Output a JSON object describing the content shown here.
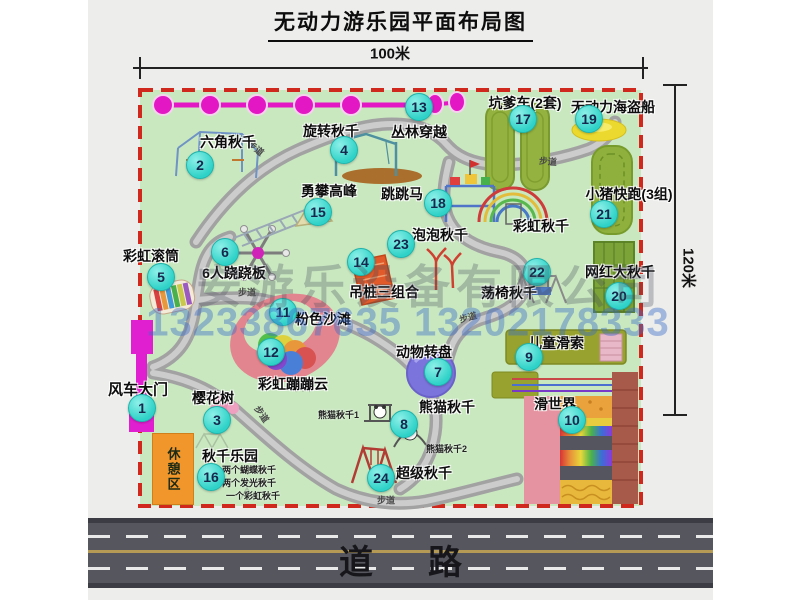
{
  "title": "无动力游乐园平面布局图",
  "dim_top": "100米",
  "dim_right": "120米",
  "road_label": "道路",
  "walkway": "步道",
  "rest_area": "休憩区",
  "watermark": {
    "company": "安游乐设备有限公司",
    "phone": "13233867635 13202178333"
  },
  "attractions": {
    "a1": {
      "num": "1",
      "label": "风车大门"
    },
    "a2": {
      "num": "2",
      "label": "六角秋千"
    },
    "a3": {
      "num": "3",
      "label": "樱花树"
    },
    "a4": {
      "num": "4",
      "label": "旋转秋千"
    },
    "a5": {
      "num": "5",
      "label": "彩虹滚筒"
    },
    "a6": {
      "num": "6",
      "label": "6人跷跷板"
    },
    "a7": {
      "num": "7",
      "label": "动物转盘"
    },
    "a8": {
      "num": "8",
      "label": "熊猫秋千"
    },
    "a9": {
      "num": "9",
      "label": "儿童滑索"
    },
    "a10": {
      "num": "10",
      "label": "滑世界"
    },
    "a11": {
      "num": "11",
      "label": "粉色沙滩"
    },
    "a12": {
      "num": "12",
      "label": "彩虹蹦蹦云"
    },
    "a13": {
      "num": "13",
      "label": "丛林穿越"
    },
    "a14": {
      "num": "14",
      "label": "吊桩三组合"
    },
    "a15": {
      "num": "15",
      "label": "勇攀高峰"
    },
    "a16": {
      "num": "16",
      "label": "秋千乐园"
    },
    "a17": {
      "num": "17",
      "label": "坑爹车(2套)"
    },
    "a18": {
      "num": "18",
      "label": "跳跳马"
    },
    "a19": {
      "num": "19",
      "label": "无动力海盗船"
    },
    "a20": {
      "num": "20",
      "label": "网红大秋千"
    },
    "a21": {
      "num": "21",
      "label": "小猪快跑(3组)"
    },
    "a22": {
      "num": "22",
      "label": "荡椅秋千"
    },
    "a23": {
      "num": "23",
      "label": "泡泡秋千"
    },
    "a24": {
      "num": "24",
      "label": "超级秋千"
    },
    "rainbow": {
      "label": "彩虹秋千"
    }
  },
  "notes": {
    "swing_park": [
      "两个蝴蝶秋千",
      "两个发光秋千",
      "一个彩虹秋千"
    ],
    "panda1": "熊猫秋千1",
    "panda2": "熊猫秋千2"
  }
}
